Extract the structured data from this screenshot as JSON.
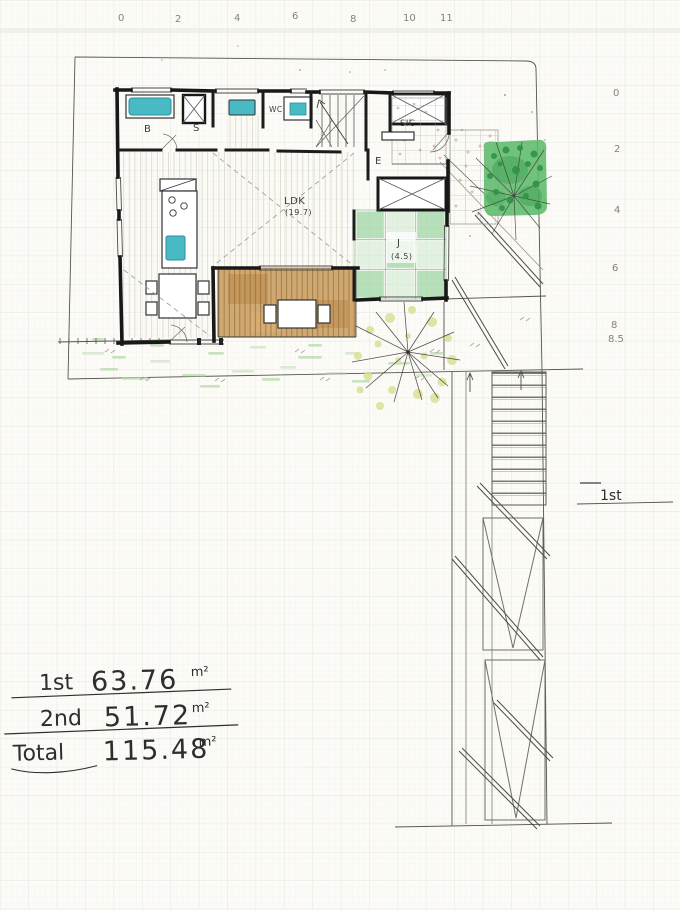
{
  "rulers": {
    "top": [
      "0",
      "2",
      "4",
      "6",
      "8",
      "10",
      "11"
    ],
    "right": [
      "0",
      "2",
      "4",
      "6",
      "8",
      "8.5"
    ]
  },
  "plan": {
    "floor_label": "1st",
    "rooms": {
      "bath": "B",
      "storage": "S",
      "wc": "WC",
      "shoe_closet": "SIC",
      "entrance": "E",
      "ldk": "LDK",
      "ldk_area": "(19.7)",
      "tatami": "J",
      "tatami_area": "(4.5)"
    }
  },
  "area_table": {
    "rows": [
      {
        "label": "1st",
        "value": "63.76",
        "unit": "m²"
      },
      {
        "label": "2nd",
        "value": "51.72",
        "unit": "m²"
      },
      {
        "label": "Total",
        "value": "115.48",
        "unit": "m²"
      }
    ]
  },
  "colors": {
    "paper": "#fcfbf7",
    "grid": "#e3e9e2",
    "ink": "#1a1a1a",
    "pencil": "#83837b",
    "fixture_teal": "#49b9c4",
    "tatami_green": "#8ccf94",
    "tree_green": "#5cb96b",
    "deck_brown": "#c8995a",
    "grass_green": "#b4d8a6",
    "garden_dot": "#d9dd8e",
    "tile_speckle": "#c98d66"
  }
}
